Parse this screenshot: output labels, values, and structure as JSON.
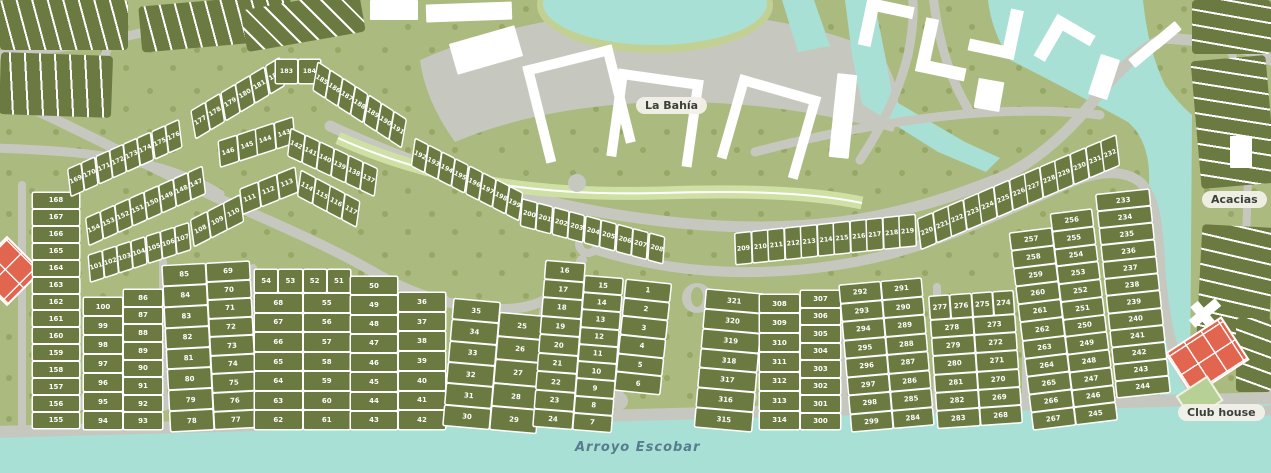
{
  "title": "Residential masterplan map",
  "labels": {
    "la_bahia": "La Bahía",
    "acacias": "Acacias",
    "club_house": "Club house",
    "arroyo_escobar": "Arroyo Escobar"
  },
  "colors": {
    "water": "#a8e0d6",
    "road": "#c6c8c0",
    "field_green": "#abba7e",
    "lot_green": "#6b7a41",
    "median_green": "#cfe0a5",
    "building_white": "#ffffff",
    "clubhouse_orange": "#e2654f"
  },
  "blocks": {
    "b155_168": {
      "col": [
        "168",
        "167",
        "166",
        "165",
        "164",
        "163",
        "162",
        "161",
        "160",
        "159",
        "158",
        "157",
        "156",
        "155"
      ]
    },
    "b86_100": {
      "col1": [
        "100",
        "99",
        "98",
        "97",
        "96",
        "95",
        "94"
      ],
      "col2": [
        "86",
        "87",
        "88",
        "89",
        "90",
        "91",
        "92",
        "93"
      ]
    },
    "b69_85": {
      "col1": [
        "85",
        "84",
        "83",
        "82",
        "81",
        "80",
        "79",
        "78"
      ],
      "col2": [
        "69",
        "70",
        "71",
        "72",
        "73",
        "74",
        "75",
        "76",
        "77"
      ]
    },
    "b51_68": {
      "top": [
        "54",
        "53",
        "52",
        "51"
      ],
      "col1": [
        "68",
        "67",
        "66",
        "65",
        "64",
        "63",
        "62"
      ],
      "col2": [
        "55",
        "56",
        "57",
        "58",
        "59",
        "60",
        "61"
      ]
    },
    "b36_50": {
      "col1": [
        "50",
        "49",
        "48",
        "47",
        "46",
        "45",
        "44",
        "43"
      ],
      "col2": [
        "36",
        "37",
        "38",
        "39",
        "40",
        "41",
        "42"
      ]
    },
    "b25_35": {
      "col1": [
        "35",
        "34",
        "33",
        "32",
        "31",
        "30"
      ],
      "col2": [
        "25",
        "26",
        "27",
        "28",
        "29"
      ]
    },
    "b7_24": {
      "col1": [
        "16",
        "17",
        "18",
        "19",
        "20",
        "21",
        "22",
        "23",
        "24"
      ],
      "col2": [
        "15",
        "14",
        "13",
        "12",
        "11",
        "10",
        "9",
        "8",
        "7"
      ]
    },
    "b1_6": {
      "col": [
        "1",
        "2",
        "3",
        "4",
        "5",
        "6"
      ]
    },
    "b315_321": {
      "col": [
        "321",
        "320",
        "319",
        "318",
        "317",
        "316",
        "315"
      ]
    },
    "b300_314": {
      "col1": [
        "308",
        "309",
        "310",
        "311",
        "312",
        "313",
        "314"
      ],
      "col2": [
        "307",
        "306",
        "305",
        "304",
        "303",
        "302",
        "301",
        "300"
      ]
    },
    "b284_299": {
      "col1": [
        "292",
        "293",
        "294",
        "295",
        "296",
        "297",
        "298",
        "299"
      ],
      "col2": [
        "291",
        "290",
        "289",
        "288",
        "287",
        "286",
        "285",
        "284"
      ]
    },
    "b268_283": {
      "top": [
        "277",
        "276",
        "275",
        "274"
      ],
      "col1": [
        "278",
        "279",
        "280",
        "281",
        "282",
        "283"
      ],
      "col2": [
        "273",
        "272",
        "271",
        "270",
        "269",
        "268"
      ]
    },
    "b245_267": {
      "col1": [
        "257",
        "258",
        "259",
        "260",
        "261",
        "262",
        "263",
        "264",
        "265",
        "266",
        "267"
      ],
      "col2": [
        "256",
        "255",
        "254",
        "253",
        "252",
        "251",
        "250",
        "249",
        "248",
        "247",
        "246",
        "245"
      ]
    },
    "b233_244": {
      "col": [
        "233",
        "234",
        "235",
        "236",
        "237",
        "238",
        "239",
        "240",
        "241",
        "242",
        "243",
        "244"
      ]
    }
  },
  "strips": {
    "r101": [
      "101",
      "102",
      "103",
      "104",
      "105",
      "106",
      "107"
    ],
    "r108": [
      "108",
      "109",
      "110"
    ],
    "r147": [
      "154",
      "153",
      "152",
      "151",
      "150",
      "149",
      "148",
      "147"
    ],
    "r169": [
      "169",
      "170",
      "171",
      "172",
      "173",
      "174",
      "175",
      "176"
    ],
    "r177a": [
      "177",
      "178",
      "179",
      "180",
      "181",
      "182"
    ],
    "r177b": [
      "183",
      "184"
    ],
    "r177c": [
      "185",
      "186",
      "187",
      "188",
      "189",
      "190",
      "191"
    ],
    "r137a": [
      "146",
      "145",
      "144",
      "143"
    ],
    "r137b": [
      "142",
      "141",
      "140",
      "139",
      "138",
      "137"
    ],
    "r111a": [
      "111",
      "112",
      "113"
    ],
    "r111b": [
      "114",
      "115",
      "116",
      "117"
    ],
    "r192a": [
      "192",
      "193",
      "194",
      "195",
      "196",
      "197",
      "198",
      "199"
    ],
    "r192b": [
      "200",
      "201",
      "202",
      "203",
      "204",
      "205",
      "206",
      "207",
      "208"
    ],
    "r209": [
      "209",
      "210",
      "211",
      "212",
      "213",
      "214",
      "215",
      "216",
      "217",
      "218",
      "219"
    ],
    "r220": [
      "220",
      "221",
      "222",
      "223",
      "224",
      "225",
      "226",
      "227",
      "228",
      "229",
      "230",
      "231",
      "232"
    ]
  }
}
